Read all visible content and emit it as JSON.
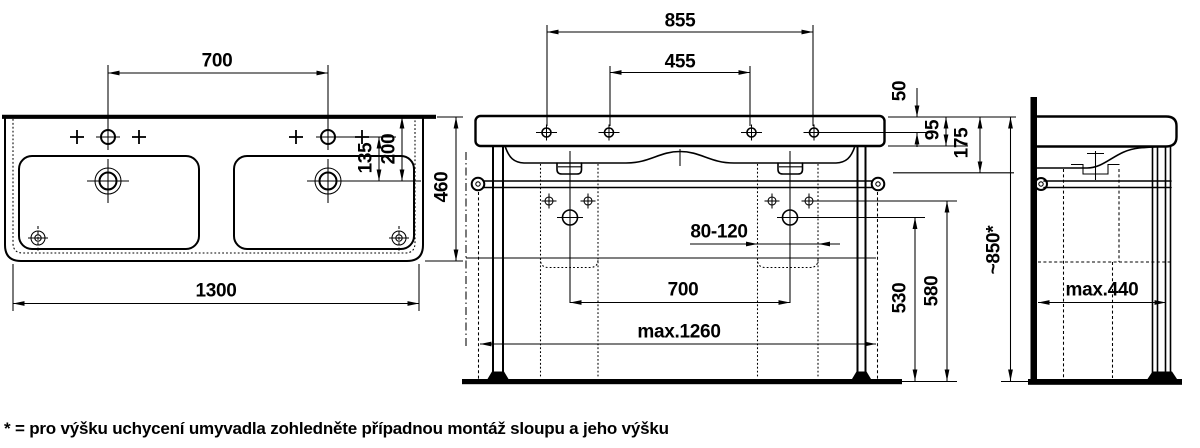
{
  "dims": {
    "top": {
      "faucet_spacing": "700",
      "basin_width": "1300",
      "hole_to_drain": "135",
      "drain_to_back": "200",
      "basin_depth": "460"
    },
    "front": {
      "outer_fix_holes": "855",
      "inner_fix_holes": "455",
      "top_to_holes": "50",
      "apron_height": "95",
      "top_to_rail": "175",
      "drain_offset_range": "80-120",
      "drain_spacing": "700",
      "rail_width_max": "max.1260",
      "trap_height": "530",
      "valve_height": "580",
      "install_height": "~850*"
    },
    "side": {
      "depth_max": "max.440"
    }
  },
  "footnote": "* = pro výšku uchycení umyvadla zohledněte případnou montáž sloupu a jeho výšku",
  "colors": {
    "line": "#000000",
    "background": "#ffffff"
  }
}
